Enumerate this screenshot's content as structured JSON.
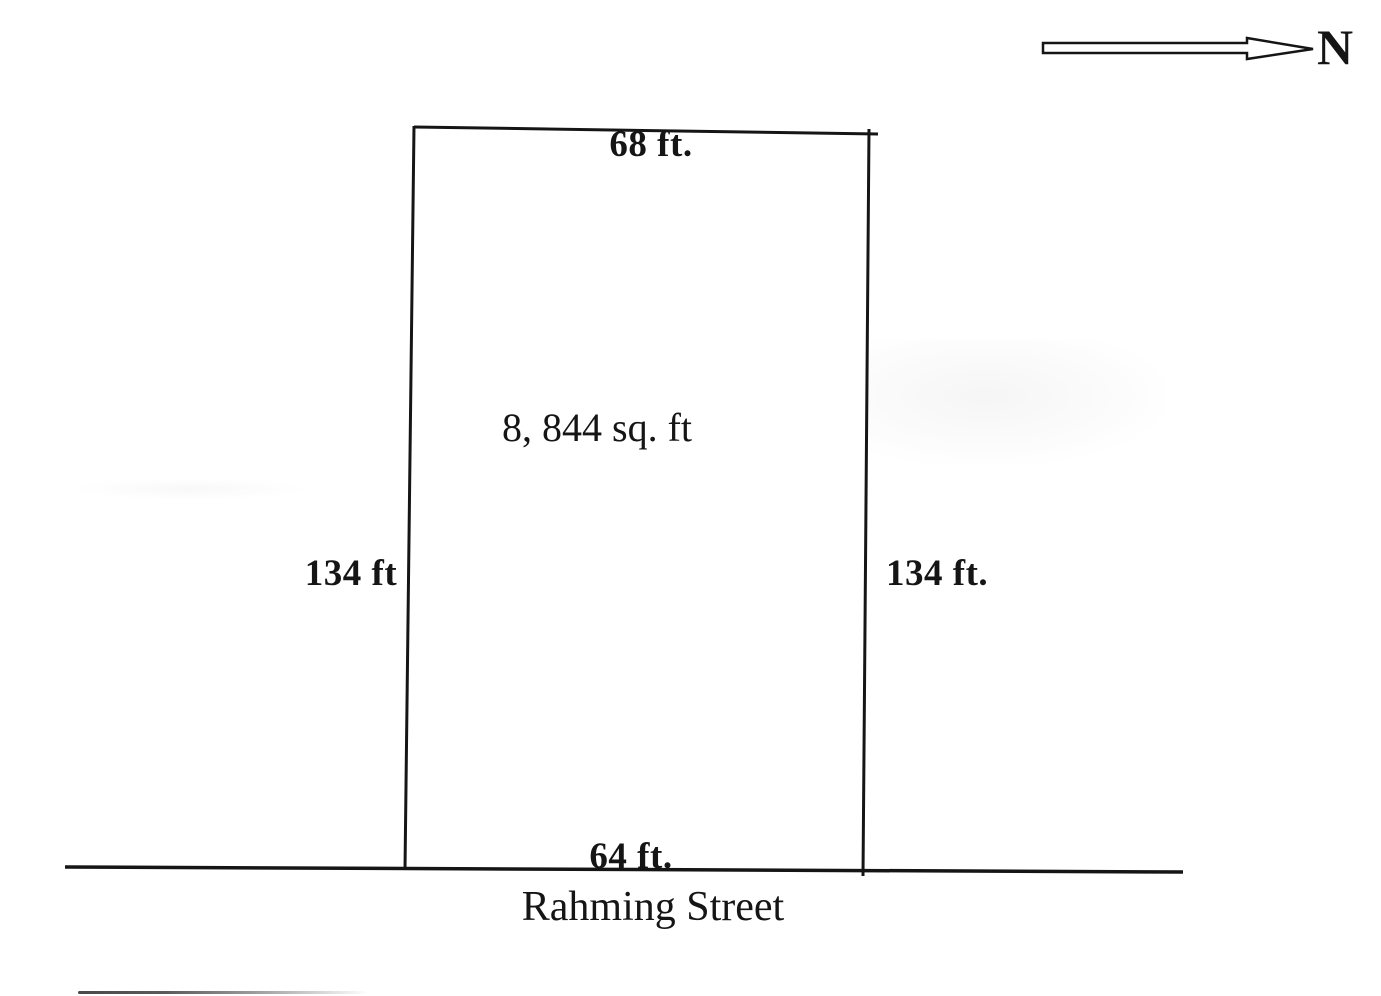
{
  "diagram": {
    "kind": "land-plot-survey",
    "north_arrow": {
      "label": "N",
      "direction": "right"
    },
    "lot": {
      "area": "8, 844 sq. ft",
      "top_side": "68 ft.",
      "left_side": "134 ft",
      "right_side": "134 ft.",
      "bottom_side": "64 ft.",
      "street": "Rahming Street"
    },
    "colors": {
      "ink": "#151515",
      "paper": "#ffffff"
    }
  }
}
